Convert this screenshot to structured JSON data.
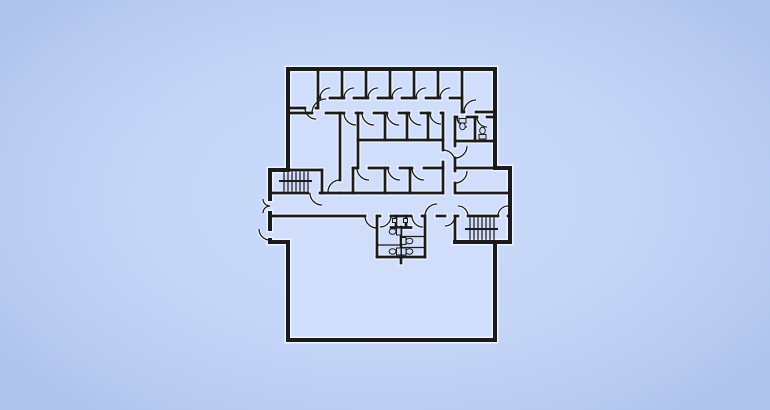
{
  "floorplan": {
    "title": "building-floor-plan",
    "canvas": {
      "w": 770,
      "h": 410
    },
    "palette": {
      "bg_center": "#cddcfb",
      "bg_edge": "#b2c5ec",
      "interior": "#d0defb",
      "wall": "#1b1b1b",
      "halo": "#eef4ff"
    },
    "footprint": [
      [
        288,
        69
      ],
      [
        495,
        69
      ],
      [
        495,
        168
      ],
      [
        510,
        168
      ],
      [
        510,
        242
      ],
      [
        495,
        242
      ],
      [
        495,
        340
      ],
      [
        288,
        340
      ],
      [
        288,
        242
      ],
      [
        270,
        242
      ],
      [
        270,
        170
      ],
      [
        288,
        170
      ]
    ],
    "walls_outer": [
      [
        288,
        69,
        495,
        69
      ],
      [
        495,
        69,
        495,
        168
      ],
      [
        495,
        168,
        510,
        168
      ],
      [
        510,
        168,
        510,
        242
      ],
      [
        455,
        242,
        510,
        242
      ],
      [
        495,
        242,
        495,
        340
      ],
      [
        288,
        340,
        495,
        340
      ],
      [
        288,
        242,
        288,
        340
      ],
      [
        270,
        242,
        288,
        242
      ],
      [
        288,
        69,
        288,
        170
      ],
      [
        270,
        170,
        288,
        170
      ],
      [
        270,
        170,
        270,
        199
      ],
      [
        270,
        213,
        270,
        229
      ],
      [
        270,
        240,
        270,
        242
      ]
    ],
    "walls_inner": [
      [
        288,
        108,
        305,
        108
      ],
      [
        316,
        108,
        318,
        108
      ],
      [
        318,
        69,
        318,
        108
      ],
      [
        342,
        69,
        342,
        98
      ],
      [
        366,
        69,
        366,
        98
      ],
      [
        390,
        69,
        390,
        98
      ],
      [
        414,
        69,
        414,
        98
      ],
      [
        438,
        69,
        438,
        98
      ],
      [
        462,
        69,
        462,
        112
      ],
      [
        318,
        98,
        320,
        98
      ],
      [
        330,
        98,
        344,
        98
      ],
      [
        354,
        98,
        368,
        98
      ],
      [
        378,
        98,
        392,
        98
      ],
      [
        402,
        98,
        416,
        98
      ],
      [
        426,
        98,
        440,
        98
      ],
      [
        450,
        98,
        462,
        98
      ],
      [
        462,
        112,
        464,
        112
      ],
      [
        476,
        112,
        495,
        112
      ],
      [
        288,
        113,
        312,
        113
      ],
      [
        326,
        113,
        344,
        113
      ],
      [
        356,
        113,
        362,
        113
      ],
      [
        374,
        113,
        387,
        113
      ],
      [
        399,
        113,
        409,
        113
      ],
      [
        421,
        113,
        430,
        113
      ],
      [
        441,
        113,
        443,
        113
      ],
      [
        340,
        113,
        340,
        180
      ],
      [
        358,
        113,
        358,
        168
      ],
      [
        358,
        140,
        443,
        140
      ],
      [
        385,
        113,
        385,
        140
      ],
      [
        407,
        113,
        407,
        140
      ],
      [
        428,
        113,
        428,
        140
      ],
      [
        443,
        113,
        443,
        150
      ],
      [
        443,
        162,
        443,
        193
      ],
      [
        353,
        168,
        357,
        168
      ],
      [
        369,
        168,
        388,
        168
      ],
      [
        400,
        168,
        412,
        168
      ],
      [
        424,
        168,
        443,
        168
      ],
      [
        353,
        168,
        353,
        193
      ],
      [
        385,
        168,
        385,
        193
      ],
      [
        410,
        168,
        410,
        193
      ],
      [
        340,
        193,
        443,
        193
      ],
      [
        288,
        170,
        322,
        170
      ],
      [
        322,
        170,
        322,
        193
      ],
      [
        270,
        193,
        308,
        193
      ],
      [
        320,
        193,
        322,
        193
      ],
      [
        322,
        193,
        340,
        193
      ],
      [
        457,
        193,
        510,
        193
      ],
      [
        455,
        117,
        457,
        117
      ],
      [
        467,
        117,
        477,
        117
      ],
      [
        487,
        117,
        495,
        117
      ],
      [
        475,
        117,
        475,
        141
      ],
      [
        455,
        141,
        495,
        141
      ],
      [
        455,
        117,
        455,
        146
      ],
      [
        455,
        158,
        455,
        171
      ],
      [
        455,
        183,
        455,
        193
      ],
      [
        455,
        168,
        495,
        168
      ],
      [
        455,
        216,
        455,
        242
      ],
      [
        270,
        216,
        365,
        216
      ],
      [
        377,
        216,
        380,
        216
      ],
      [
        391,
        216,
        411,
        216
      ],
      [
        422,
        216,
        425,
        216
      ],
      [
        437,
        216,
        445,
        216
      ],
      [
        455,
        216,
        458,
        216
      ],
      [
        468,
        216,
        498,
        216
      ],
      [
        508,
        216,
        510,
        216
      ],
      [
        377,
        216,
        377,
        257
      ],
      [
        425,
        216,
        425,
        257
      ],
      [
        377,
        257,
        425,
        257
      ],
      [
        401,
        257,
        401,
        263
      ],
      [
        396,
        216,
        396,
        227
      ],
      [
        406,
        216,
        406,
        227
      ],
      [
        391,
        227.5,
        411,
        227.5
      ],
      [
        401,
        227,
        401,
        257
      ]
    ],
    "walls_thin": [
      [
        284,
        172,
        284,
        191
      ],
      [
        288,
        172,
        288,
        191
      ],
      [
        292,
        172,
        292,
        191
      ],
      [
        296,
        172,
        296,
        191
      ],
      [
        300,
        172,
        300,
        191
      ],
      [
        304,
        172,
        304,
        191
      ],
      [
        308,
        172,
        308,
        191
      ],
      [
        470,
        218,
        470,
        240
      ],
      [
        474,
        218,
        474,
        240
      ],
      [
        478,
        218,
        478,
        240
      ],
      [
        482,
        218,
        482,
        240
      ],
      [
        486,
        218,
        486,
        240
      ],
      [
        490,
        218,
        490,
        240
      ],
      [
        494,
        218,
        494,
        240
      ],
      [
        401,
        236.5,
        425,
        236.5
      ],
      [
        377,
        245,
        401,
        245
      ],
      [
        401,
        247.5,
        425,
        247.5
      ]
    ],
    "walls_mid": [
      [
        280,
        181,
        311,
        181
      ],
      [
        466,
        229,
        497,
        229
      ]
    ],
    "door_arcs": [
      [
        330,
        98,
        10,
        180,
        270
      ],
      [
        354,
        98,
        10,
        180,
        270
      ],
      [
        378,
        98,
        10,
        180,
        270
      ],
      [
        402,
        98,
        10,
        180,
        270
      ],
      [
        426,
        98,
        10,
        180,
        270
      ],
      [
        450,
        98,
        10,
        180,
        270
      ],
      [
        316,
        108,
        11,
        90,
        180
      ],
      [
        476,
        112,
        12,
        180,
        270
      ],
      [
        356,
        113,
        12,
        90,
        180
      ],
      [
        374,
        113,
        12,
        90,
        180
      ],
      [
        399,
        113,
        12,
        90,
        180
      ],
      [
        421,
        113,
        12,
        90,
        180
      ],
      [
        441,
        113,
        11,
        90,
        180
      ],
      [
        326,
        113,
        14,
        180,
        270
      ],
      [
        340,
        192,
        12,
        180,
        270
      ],
      [
        443,
        162,
        12,
        270,
        360
      ],
      [
        369,
        168,
        12,
        90,
        180
      ],
      [
        400,
        168,
        12,
        90,
        180
      ],
      [
        424,
        168,
        12,
        90,
        180
      ],
      [
        467,
        117,
        10,
        90,
        180
      ],
      [
        487,
        117,
        10,
        90,
        180
      ],
      [
        455,
        146,
        12,
        0,
        90
      ],
      [
        455,
        171,
        12,
        0,
        90
      ],
      [
        322,
        193,
        12,
        90,
        180
      ],
      [
        270,
        199,
        7,
        90,
        180
      ],
      [
        270,
        213,
        7,
        180,
        270
      ],
      [
        270,
        229,
        11,
        90,
        180
      ],
      [
        377,
        216,
        12,
        90,
        180
      ],
      [
        437,
        216,
        12,
        180,
        270
      ],
      [
        445,
        216,
        10,
        0,
        90
      ],
      [
        380,
        216,
        11,
        0,
        90
      ],
      [
        423,
        216,
        11,
        90,
        180
      ],
      [
        458,
        216,
        10,
        270,
        360
      ],
      [
        508,
        216,
        10,
        180,
        270
      ]
    ],
    "fixtures": [
      {
        "kind": "toilet",
        "tank": [
          396.5,
          228,
          4.5,
          7
        ],
        "bowl": [
          392.6,
          231.5,
          3.4,
          2.8
        ]
      },
      {
        "kind": "toilet",
        "tank": [
          396.5,
          248,
          4.5,
          7
        ],
        "bowl": [
          392.6,
          251.5,
          3.4,
          2.8
        ]
      },
      {
        "kind": "toilet",
        "tank": [
          401.5,
          237.5,
          4.5,
          7
        ],
        "bowl": [
          409.4,
          241,
          3.4,
          2.8
        ]
      },
      {
        "kind": "toilet",
        "tank": [
          401.5,
          248,
          4.5,
          7
        ],
        "bowl": [
          409.4,
          251.5,
          3.4,
          2.8
        ]
      },
      {
        "kind": "toilet",
        "tank": [
          459,
          118.5,
          7,
          4.5
        ],
        "bowl": [
          462.5,
          126.3,
          2.8,
          3.4
        ]
      },
      {
        "kind": "toilet",
        "tank": [
          479,
          134.5,
          7,
          4.5
        ],
        "bowl": [
          482.5,
          130.6,
          2.8,
          3.4
        ]
      },
      {
        "kind": "sink",
        "tank": [
          392.5,
          218.5,
          4,
          4
        ]
      },
      {
        "kind": "sink",
        "tank": [
          403.5,
          218.5,
          4,
          4
        ]
      }
    ]
  }
}
